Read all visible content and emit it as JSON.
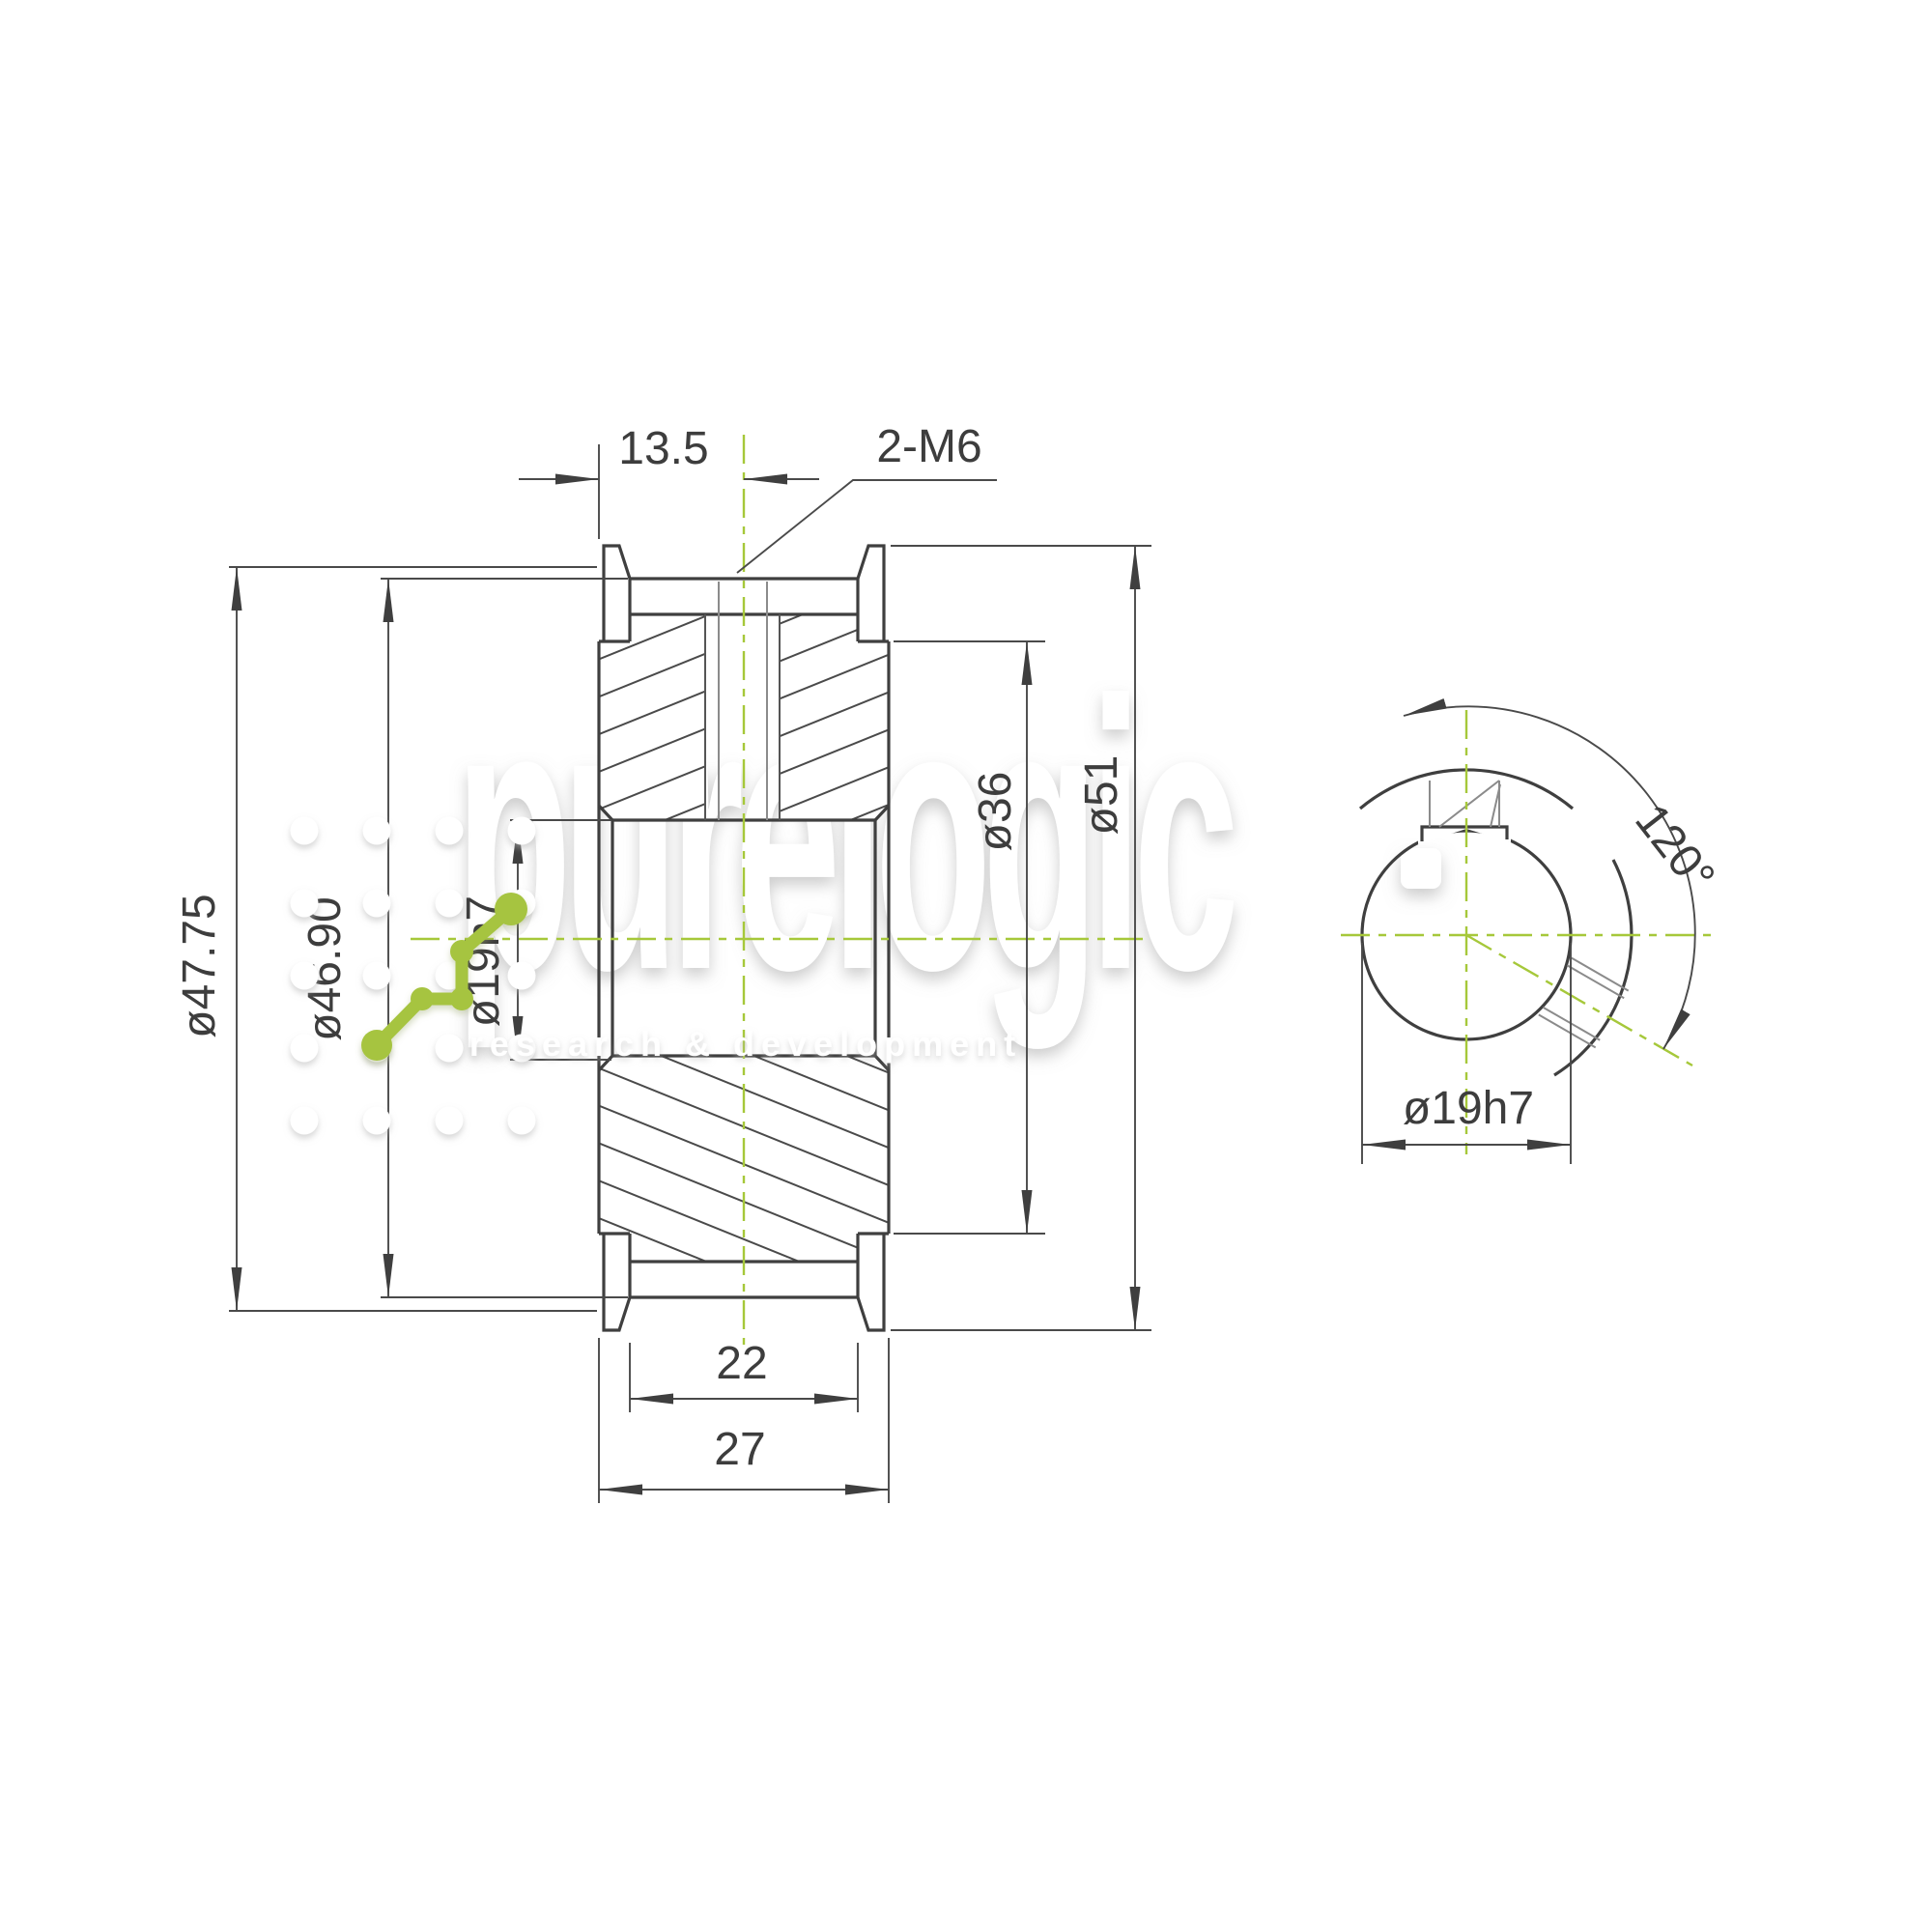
{
  "watermark": {
    "brand": "purelogic",
    "tagline": "research & development"
  },
  "section_view": {
    "width_to_screw": "13.5",
    "screws": "2-M6",
    "flange_diameter": "ø51",
    "outside_diameter": "ø47.75",
    "root_diameter": "ø46.90",
    "bore_diameter": "ø19h7",
    "hub_diameter": "ø36",
    "belt_width": "22",
    "overall_width": "27"
  },
  "end_view": {
    "bore_diameter": "ø19h7",
    "screw_angle": "120°"
  },
  "colors": {
    "line": "#3f3f3f",
    "dimension": "#4a4a4a",
    "centerline": "#a6c83a",
    "logo_green": "#a6c43f",
    "watermark_text": "#ffffff"
  }
}
